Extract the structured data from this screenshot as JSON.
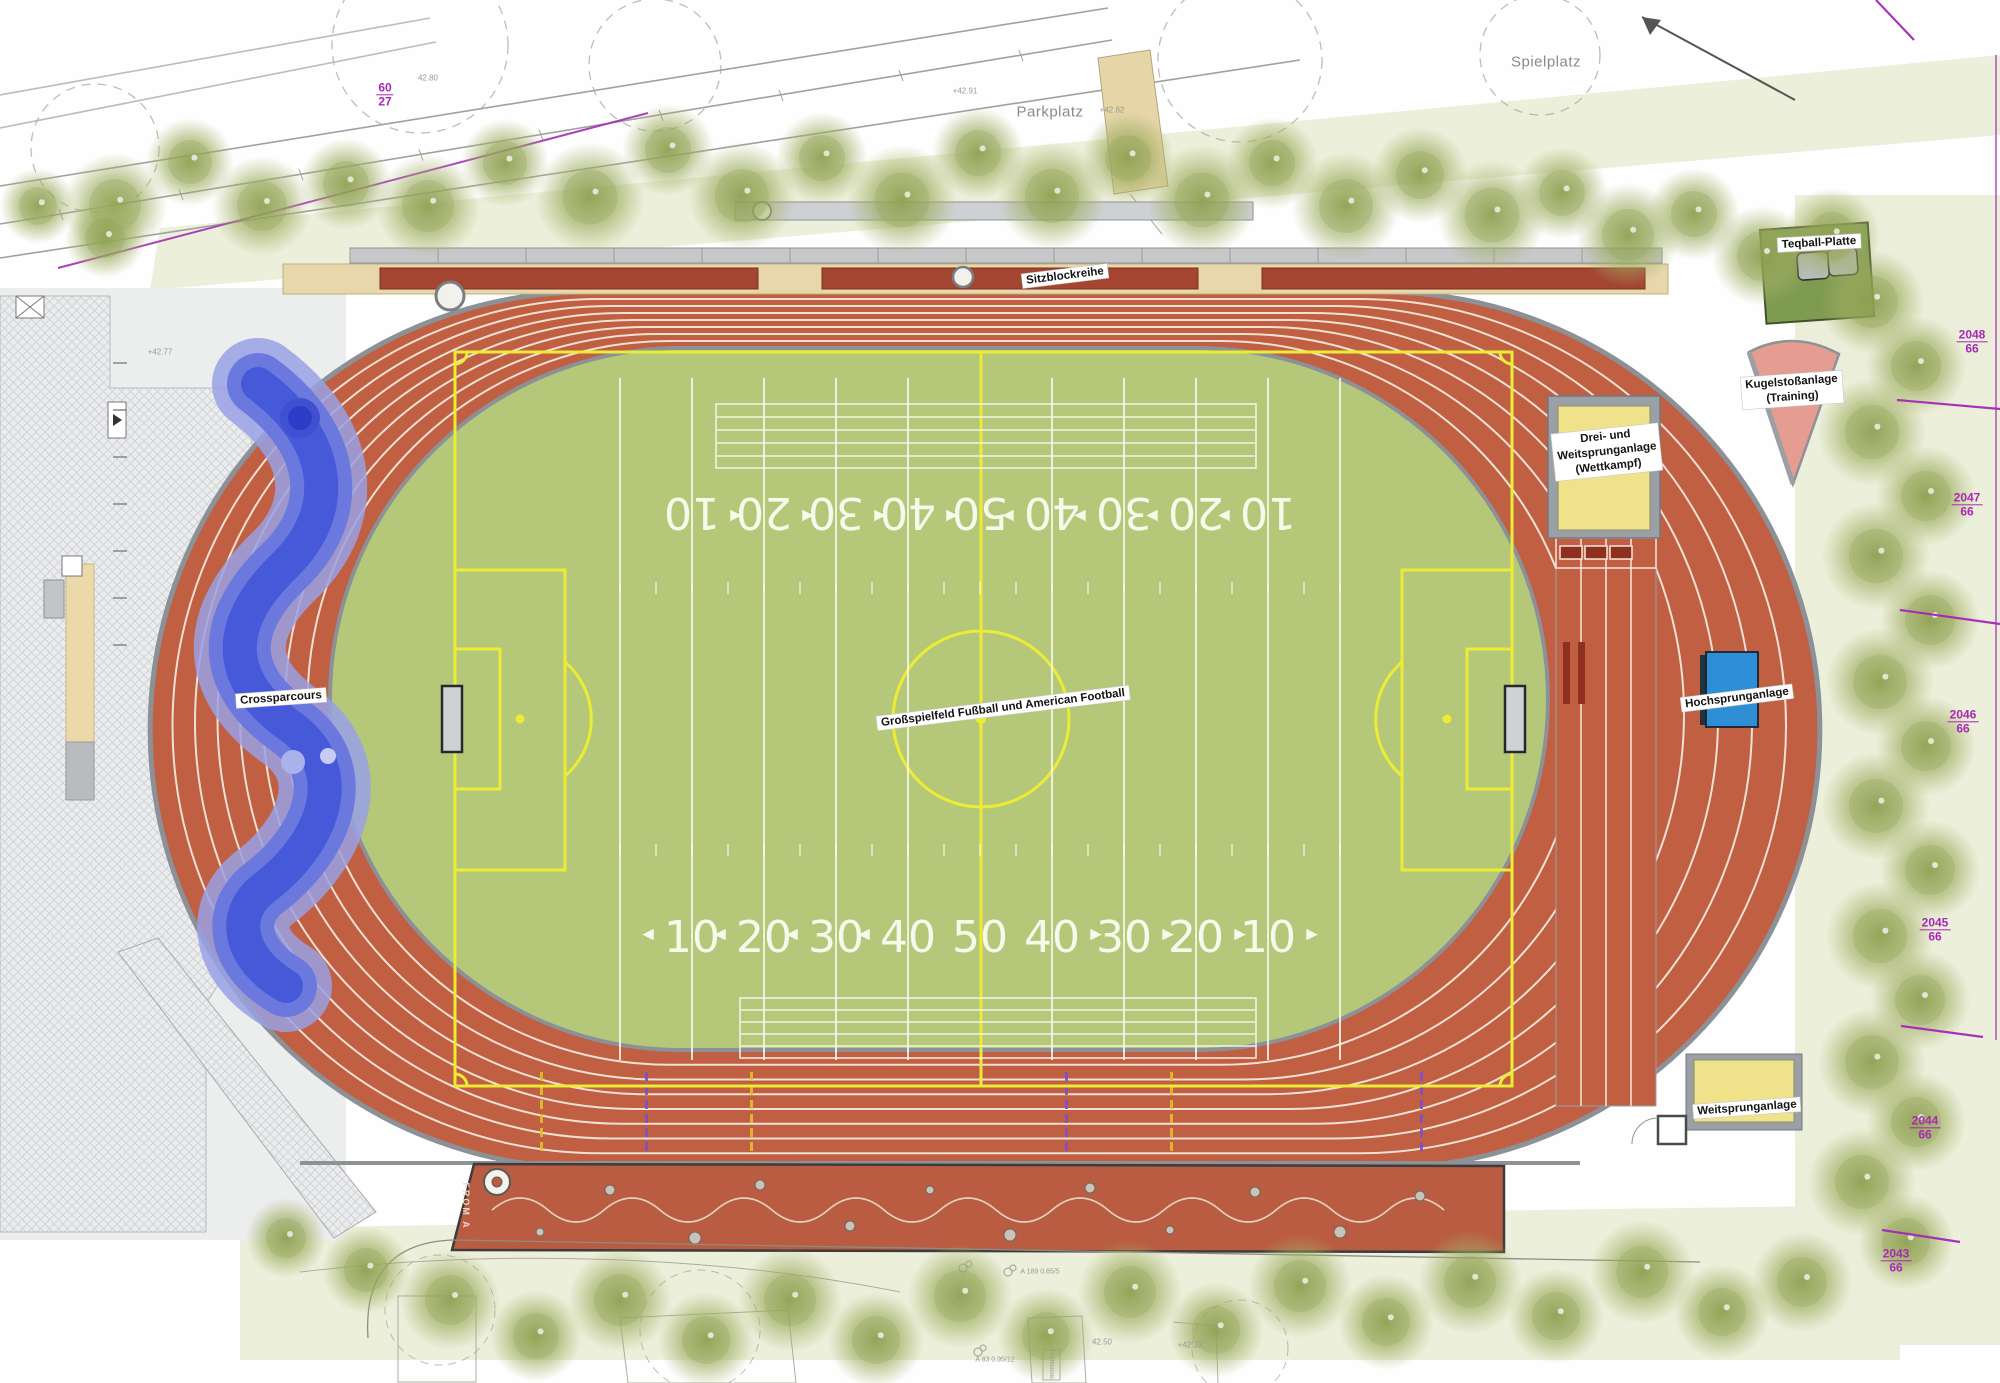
{
  "plan": {
    "facility_labels": {
      "sitzblockreihe": "Sitzblockreihe",
      "teqball": "Teqball-Platte",
      "kugelstoss_1": "Kugelstoßanlage",
      "kugelstoss_2": "(Training)",
      "dreisprung_1": "Drei- und",
      "dreisprung_2": "Weitsprunganlage",
      "dreisprung_3": "(Wettkampf)",
      "hochsprung": "Hochsprunganlage",
      "weitsprung": "Weitsprunganlage",
      "crossparcours": "Crossparcours",
      "spielfeld": "Großspielfeld Fußball und American Football",
      "from_a": "FROM A",
      "tischtennis": "Tischtennis"
    },
    "area_labels": {
      "parkplatz": "Parkplatz",
      "spielplatz": "Spielplatz"
    },
    "parcels": [
      {
        "num": "60",
        "den": "27"
      },
      {
        "num": "2048",
        "den": "66"
      },
      {
        "num": "2047",
        "den": "66"
      },
      {
        "num": "2046",
        "den": "66"
      },
      {
        "num": "2045",
        "den": "66"
      },
      {
        "num": "2044",
        "den": "66"
      },
      {
        "num": "2043",
        "den": "66"
      }
    ],
    "elevations": [
      "+42.91",
      "+42.82",
      "42.80",
      "+42.77",
      "+42.33",
      "42.50"
    ],
    "tree_tags": [
      "A 189 0.65/5",
      "A 83 0.95/12"
    ],
    "field_numbers": [
      "10",
      "20",
      "30",
      "40",
      "50",
      "40",
      "30",
      "20",
      "10"
    ],
    "colors": {
      "track": "#c05f41",
      "infield": "#b5c87a",
      "marking_yellow": "#ecec35",
      "marking_white": "#f8f8f0",
      "sand_pit": "#f0e28a",
      "high_jump_mat": "#2e8fd6",
      "shot_put": "#e59d92",
      "teqball_green": "#7e9b50",
      "crossparcours_blue": "#4557d8",
      "boundary_purple": "#a428b8",
      "tree_green": "#9fae62",
      "paver_tan": "#e7d7ab",
      "play_strip": "#b95c41"
    }
  }
}
